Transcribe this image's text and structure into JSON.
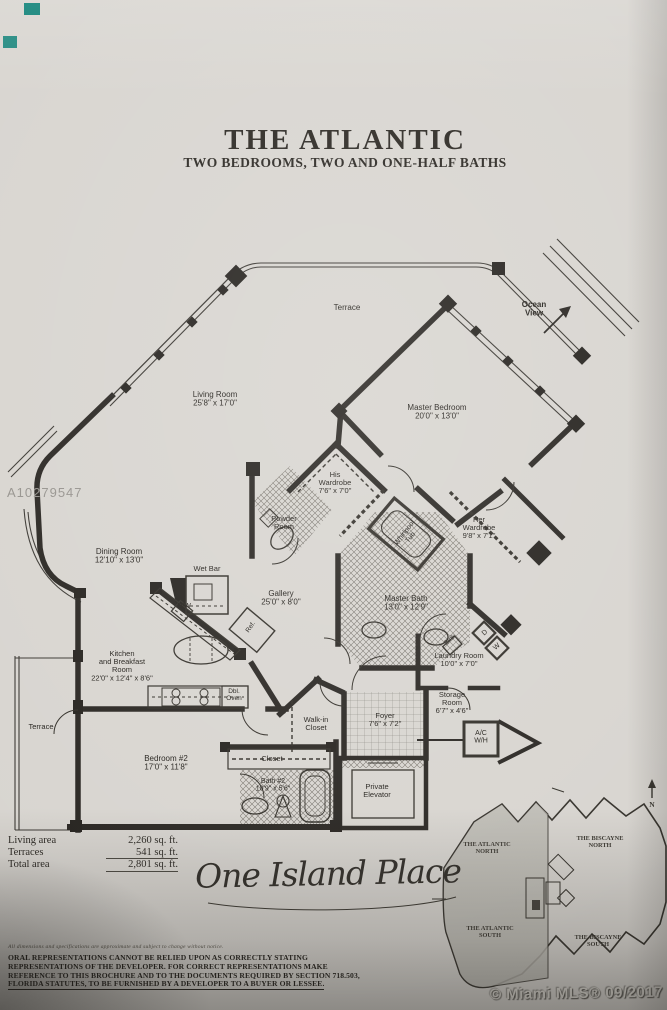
{
  "photo": {
    "listing_watermark": "A10279547",
    "mls_credit": "© Miami MLS® 09/2017",
    "accent_teal": "#0c8076",
    "paper_color": "#d8d5d0",
    "ink_color": "#2a2723"
  },
  "header": {
    "title": "THE ATLANTIC",
    "subtitle": "TWO BEDROOMS, TWO AND ONE-HALF BATHS"
  },
  "floorplan": {
    "rooms": [
      {
        "id": "terrace-top",
        "label": "Terrace",
        "x": 347,
        "y": 310,
        "size": 8
      },
      {
        "id": "ocean-view",
        "label": "Ocean\nView",
        "x": 534,
        "y": 307,
        "size": 8,
        "bold": true
      },
      {
        "id": "living-room",
        "label": "Living Room\n25'8\" x 17'0\"",
        "x": 215,
        "y": 397,
        "size": 8
      },
      {
        "id": "master-bedroom",
        "label": "Master Bedroom\n20'0\" x 13'0\"",
        "x": 437,
        "y": 410,
        "size": 8
      },
      {
        "id": "his-wardrobe",
        "label": "His\nWardrobe\n7'6\" x 7'0\"",
        "x": 335,
        "y": 477,
        "size": 7.5
      },
      {
        "id": "powder-room",
        "label": "Powder\nRoom",
        "x": 284,
        "y": 521,
        "size": 7.5
      },
      {
        "id": "whirlpool-tub",
        "label": "Whirlpool\nTub",
        "x": 406,
        "y": 534,
        "size": 7,
        "rotate": -52
      },
      {
        "id": "her-wardrobe",
        "label": "Her\nWardrobe\n9'8\" x 7'1\"",
        "x": 479,
        "y": 522,
        "size": 7.5
      },
      {
        "id": "dining-room",
        "label": "Dining Room\n12'10\" x 13'0\"",
        "x": 119,
        "y": 554,
        "size": 8
      },
      {
        "id": "wet-bar",
        "label": "Wet Bar",
        "x": 207,
        "y": 571,
        "size": 7.5
      },
      {
        "id": "dishwasher",
        "label": "D/W",
        "x": 184,
        "y": 608,
        "size": 7
      },
      {
        "id": "gallery",
        "label": "Gallery\n25'0\" x 8'0\"",
        "x": 281,
        "y": 596,
        "size": 8
      },
      {
        "id": "refrigerator",
        "label": "Ref.",
        "x": 252,
        "y": 628,
        "size": 6.5,
        "rotate": -55
      },
      {
        "id": "master-bath",
        "label": "Master Bath\n13'0\" x 12'9\"",
        "x": 406,
        "y": 601,
        "size": 8
      },
      {
        "id": "laundry-sink",
        "label": "Sink",
        "x": 451,
        "y": 641,
        "size": 6.5,
        "rotate": -42
      },
      {
        "id": "dryer",
        "label": "D",
        "x": 486,
        "y": 634,
        "size": 7,
        "rotate": -42
      },
      {
        "id": "washer",
        "label": "W",
        "x": 498,
        "y": 648,
        "size": 7,
        "rotate": -42
      },
      {
        "id": "kitchen",
        "label": "Kitchen\nand Breakfast\nRoom\n22'0\" x 12'4\" x 8'6\"",
        "x": 122,
        "y": 656,
        "size": 7.5
      },
      {
        "id": "dbl-oven",
        "label": "Dbl.\nOven",
        "x": 234,
        "y": 693,
        "size": 6.5
      },
      {
        "id": "laundry-room",
        "label": "Laundry Room\n10'0\" x 7'0\"",
        "x": 459,
        "y": 658,
        "size": 7.5
      },
      {
        "id": "storage-room",
        "label": "Storage\nRoom\n6'7\" x 4'6\"",
        "x": 452,
        "y": 697,
        "size": 7.5
      },
      {
        "id": "ac-wh",
        "label": "A/C\nW/H",
        "x": 481,
        "y": 735,
        "size": 7
      },
      {
        "id": "walk-in-closet",
        "label": "Walk-in\nCloset",
        "x": 316,
        "y": 722,
        "size": 7.5
      },
      {
        "id": "foyer",
        "label": "Foyer\n7'6\" x 7'2\"",
        "x": 385,
        "y": 718,
        "size": 7.5
      },
      {
        "id": "closet",
        "label": "Closet",
        "x": 272,
        "y": 761,
        "size": 7.5
      },
      {
        "id": "bath-2",
        "label": "Bath #2\n10'9\" x 5'6\"",
        "x": 273,
        "y": 783,
        "size": 7
      },
      {
        "id": "bedroom-2",
        "label": "Bedroom #2\n17'0\" x 11'8\"",
        "x": 166,
        "y": 761,
        "size": 8
      },
      {
        "id": "private-elevator",
        "label": "Private\nElevator",
        "x": 377,
        "y": 789,
        "size": 7.5
      },
      {
        "id": "terrace-left",
        "label": "Terrace",
        "x": 41,
        "y": 729,
        "size": 7.5
      }
    ]
  },
  "area_table": {
    "rows": [
      {
        "label": "Living area",
        "value": "2,260 sq. ft."
      },
      {
        "label": "Terraces",
        "value": "541 sq. ft."
      },
      {
        "label": "Total area",
        "value": "2,801 sq. ft."
      }
    ]
  },
  "logo": {
    "name": "One Island Place"
  },
  "keyplan": {
    "labels": [
      {
        "id": "atlantic-north",
        "label": "THE ATLANTIC\nNORTH",
        "x": 487,
        "y": 846,
        "size": 6.3,
        "serif": true
      },
      {
        "id": "biscayne-north",
        "label": "THE BISCAYNE\nNORTH",
        "x": 600,
        "y": 840,
        "size": 6.3,
        "serif": true
      },
      {
        "id": "atlantic-south",
        "label": "THE ATLANTIC\nSOUTH",
        "x": 490,
        "y": 930,
        "size": 6.3,
        "serif": true
      },
      {
        "id": "biscayne-south",
        "label": "THE BISCAYNE\nSOUTH",
        "x": 598,
        "y": 939,
        "size": 6.3,
        "serif": true
      },
      {
        "id": "compass-n",
        "label": "N",
        "x": 652,
        "y": 807,
        "size": 7.5,
        "serif": true
      }
    ]
  },
  "disclaimer": {
    "note": "All dimensions and specifications are approximate and subject to change without notice.",
    "lines": [
      "ORAL REPRESENTATIONS CANNOT BE RELIED UPON AS CORRECTLY STATING",
      "REPRESENTATIONS OF THE DEVELOPER. FOR CORRECT REPRESENTATIONS MAKE",
      "REFERENCE TO THIS BROCHURE AND TO THE DOCUMENTS REQUIRED BY SECTION 718.503,",
      "FLORIDA STATUTES, TO BE FURNISHED BY A DEVELOPER TO A BUYER OR LESSEE."
    ]
  }
}
